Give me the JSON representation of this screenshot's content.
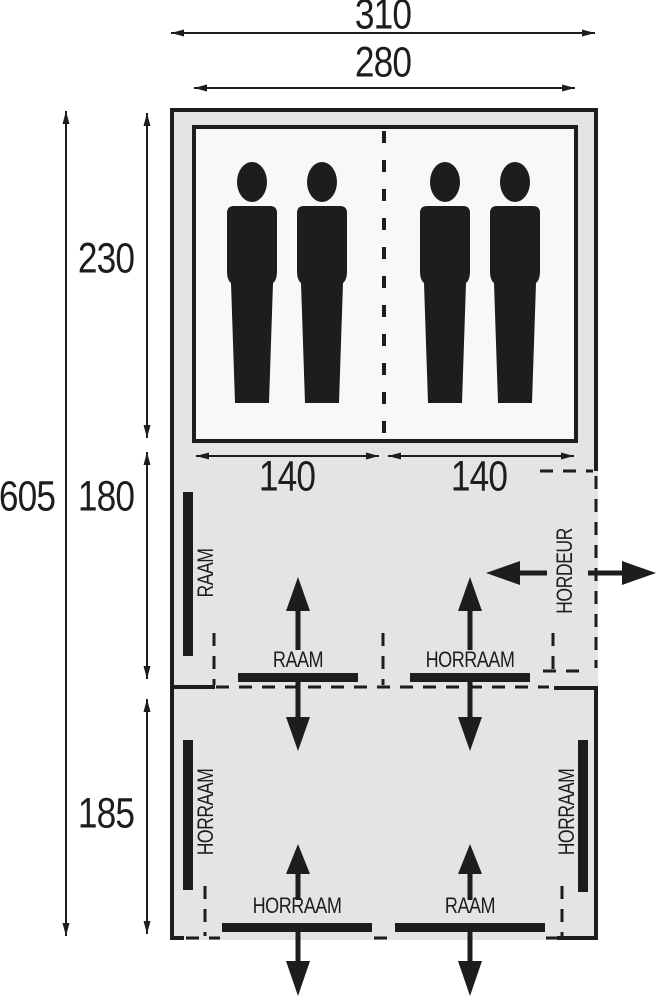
{
  "diagram": {
    "type": "tent-floorplan",
    "colors": {
      "line": "#1d1d1b",
      "tent_fill": "#e3e4e4",
      "cabin_fill": "#f8f8f8",
      "background": "#ffffff"
    },
    "dimensions": {
      "overall_width": "310",
      "inner_width": "280",
      "overall_depth": "605",
      "cabin_depth": "230",
      "living_depth": "180",
      "front_depth": "185",
      "cabin_left_width": "140",
      "cabin_right_width": "140"
    },
    "labels": {
      "window_left_wall": "RAAM",
      "window_mid": "RAAM",
      "mesh_window_mid": "HORRAAM",
      "mesh_door": "HORDEUR",
      "mesh_window_left_wall": "HORRAAM",
      "mesh_window_right_wall": "HORRAAM",
      "mesh_window_bottom": "HORRAAM",
      "window_bottom": "RAAM"
    },
    "sleeping_capacity": "4"
  }
}
